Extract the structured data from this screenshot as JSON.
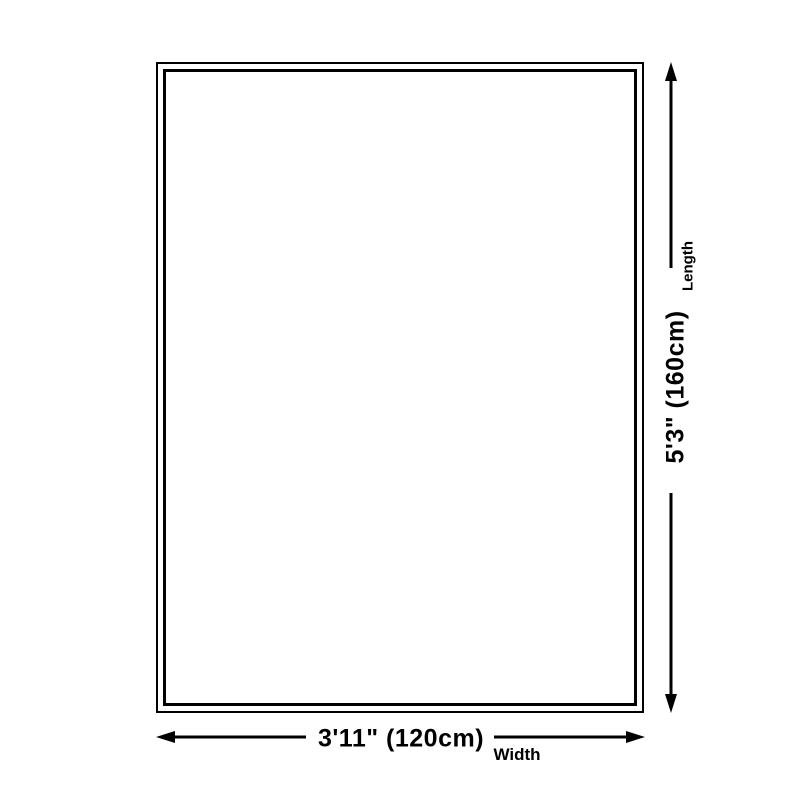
{
  "dimensions": {
    "length": {
      "value": "5'3\" (160cm)",
      "label": "Length"
    },
    "width": {
      "value": "3'11\" (120cm)",
      "label": "Width"
    }
  },
  "colors": {
    "line": "#000000",
    "background": "#ffffff"
  }
}
